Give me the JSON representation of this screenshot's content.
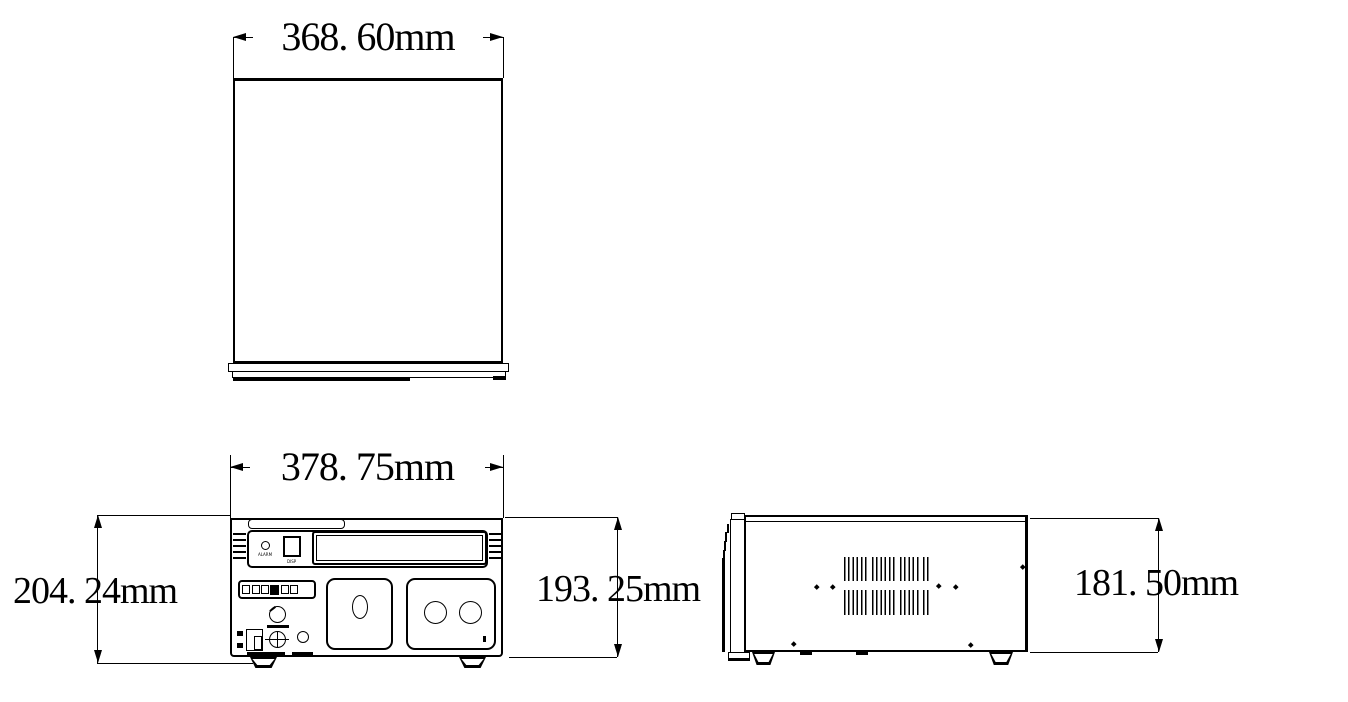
{
  "drawing": {
    "type": "technical-dimension-drawing",
    "colors": {
      "line": "#000000",
      "background": "#ffffff"
    },
    "dimensions": {
      "top_view_width": "368. 60mm",
      "front_view_width": "378. 75mm",
      "front_overall_height": "204. 24mm",
      "front_body_height": "193. 25mm",
      "side_view_height": "181. 50mm"
    },
    "front_panel": {
      "alarm_label": "ALARM",
      "disp_label": "DISP"
    }
  }
}
